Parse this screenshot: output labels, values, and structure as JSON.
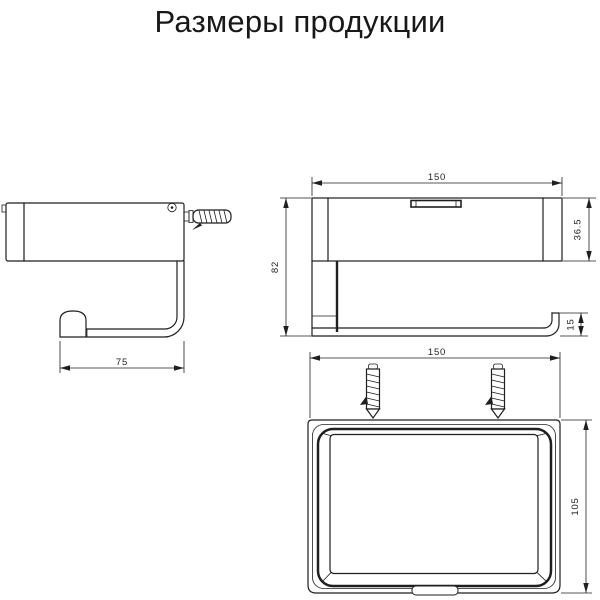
{
  "title": "Размеры продукции",
  "diagram": {
    "side_view": {
      "description": "side profile of roll holder with shelf and wall anchor",
      "depth": "75"
    },
    "front_view": {
      "description": "front elevation of shelf with roll bar and end hook",
      "width": "150",
      "height": "82",
      "shelf_height": "36.5",
      "bar_height": "15"
    },
    "top_view": {
      "description": "plan view of tray shelf with two wall anchors",
      "width": "150",
      "depth": "105"
    },
    "units": "mm"
  },
  "colors": {
    "line": "#1f1f1f",
    "background": "#ffffff",
    "text": "#181818"
  }
}
